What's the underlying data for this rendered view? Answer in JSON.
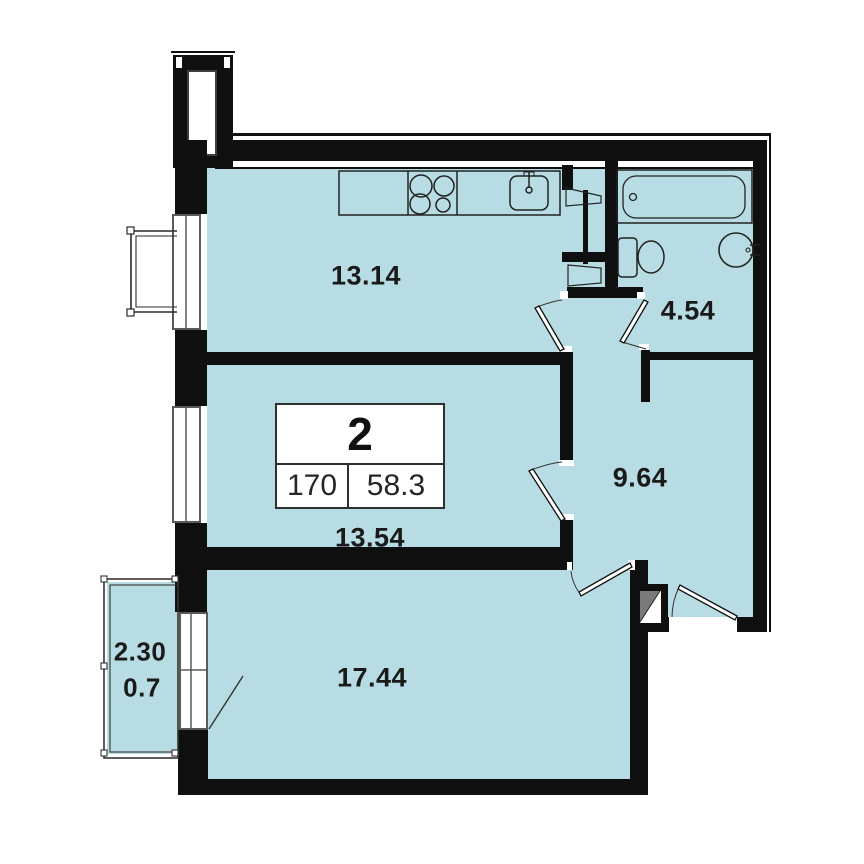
{
  "plan": {
    "title": "2-room apartment floor plan",
    "badge": {
      "rooms_count": "2",
      "cell_left": "170",
      "cell_right": "58.3"
    },
    "labels": {
      "kitchen": "13.14",
      "bathroom": "4.54",
      "hallway": "9.64",
      "room_mid": "13.54",
      "room_large": "17.44",
      "balcony_dim": "2.30",
      "balcony_area": "0.7"
    },
    "rooms": [
      {
        "id": "kitchen",
        "area_m2": "13.14",
        "fixtures": [
          "kitchen-counter",
          "stove",
          "kitchen-sink"
        ]
      },
      {
        "id": "bathroom",
        "area_m2": "4.54",
        "fixtures": [
          "bathtub",
          "toilet",
          "washbasin"
        ]
      },
      {
        "id": "hallway",
        "area_m2": "9.64",
        "fixtures": [
          "entrance-door",
          "duct-shaft"
        ]
      },
      {
        "id": "room-mid",
        "area_m2": "13.54",
        "fixtures": [
          "window"
        ]
      },
      {
        "id": "room-large",
        "area_m2": "17.44",
        "fixtures": [
          "balcony-door"
        ]
      },
      {
        "id": "balcony",
        "width_m": "2.30",
        "area_m2": "0.7",
        "fixtures": [
          "railing"
        ]
      }
    ],
    "colors": {
      "room_fill": "#b7dce3",
      "wall": "#0f0f0f",
      "fixture_line": "#222222",
      "label_text": "#1a1a1a"
    }
  }
}
